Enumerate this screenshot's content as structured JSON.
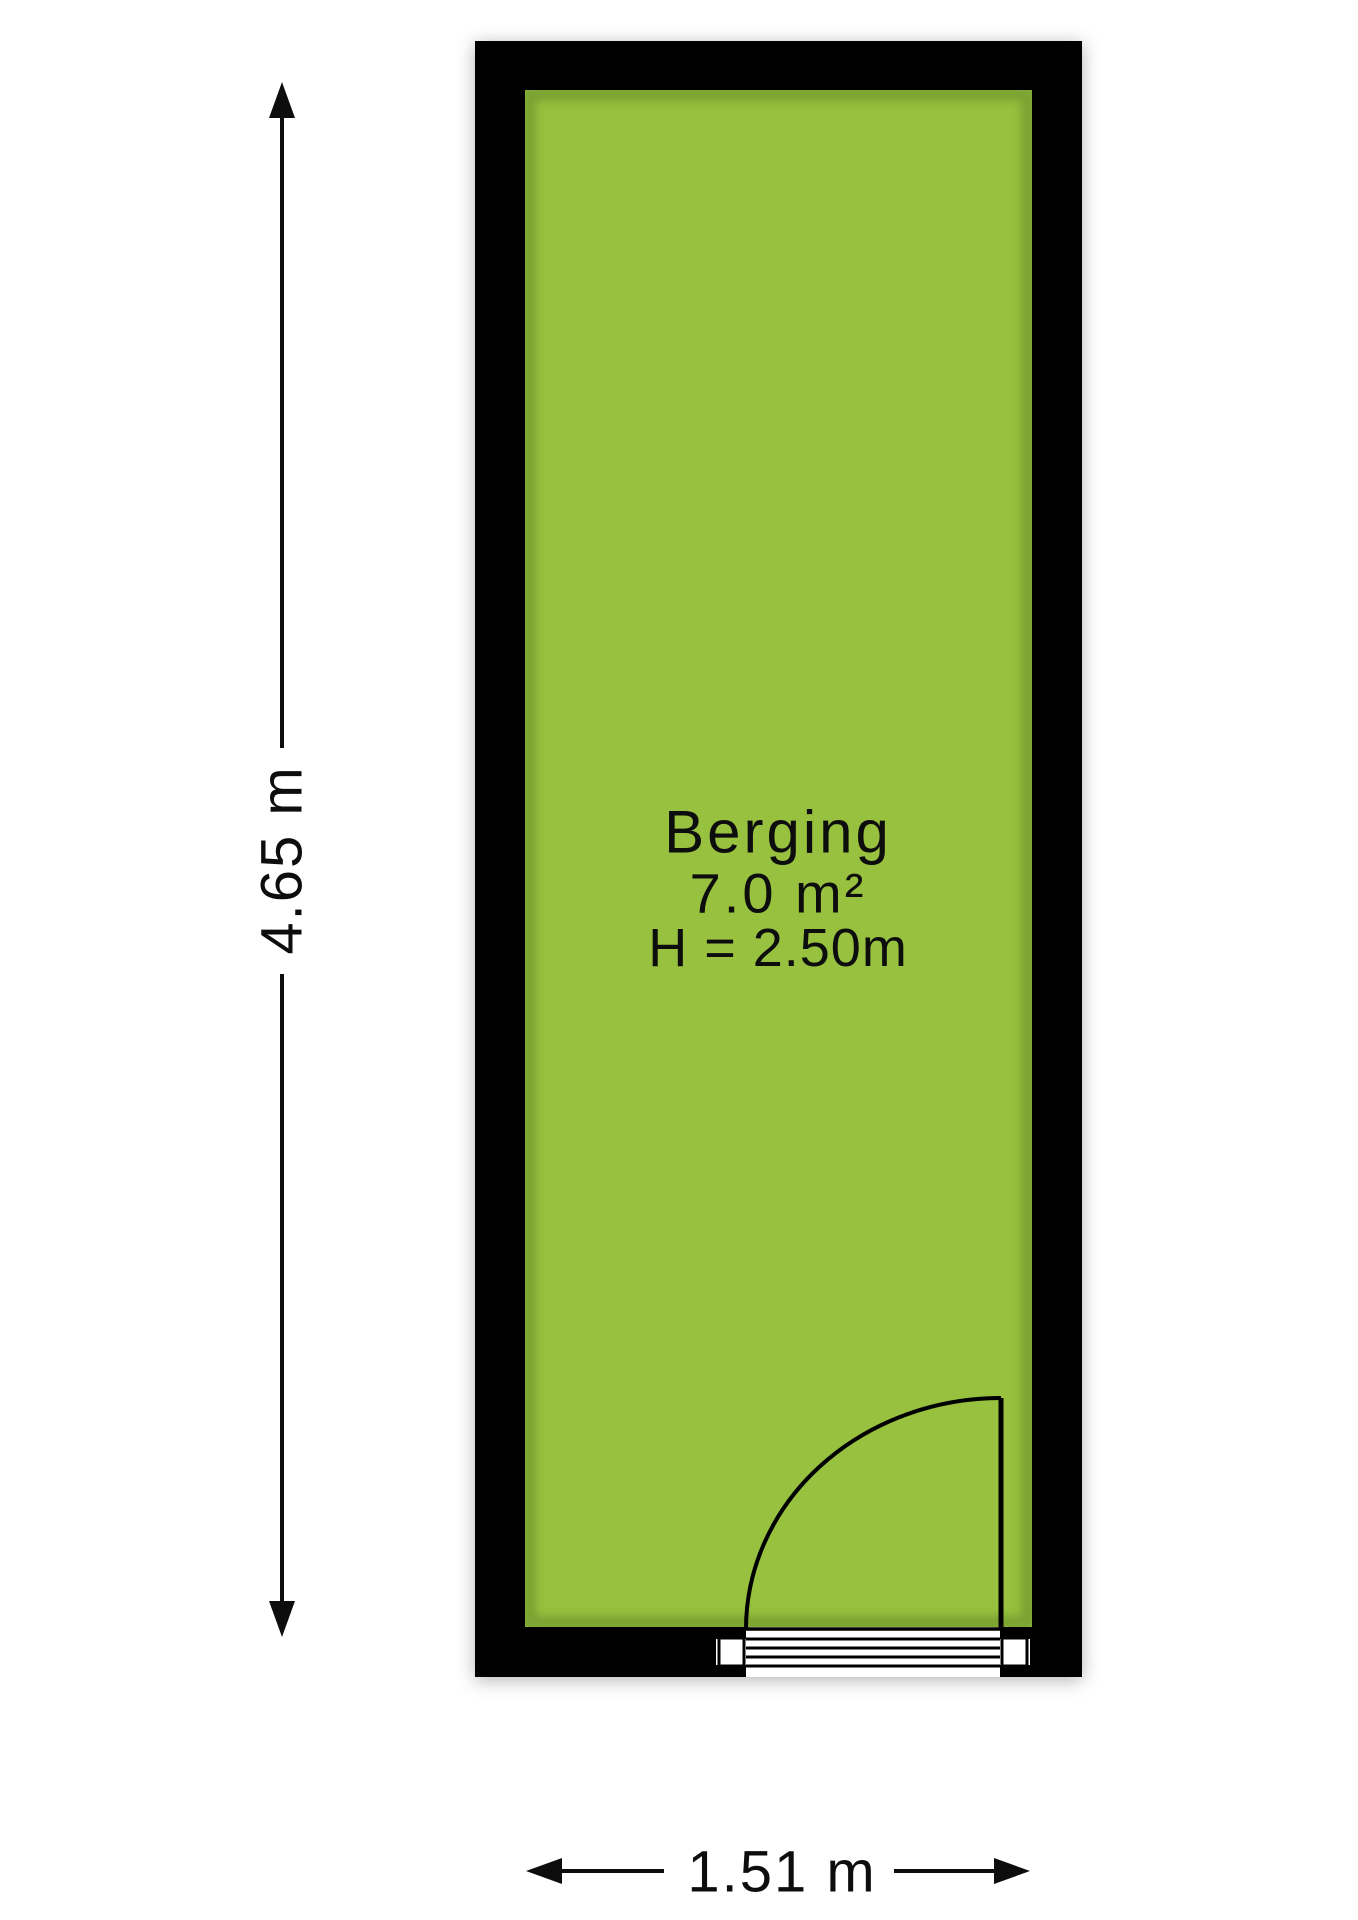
{
  "floorplan": {
    "room": {
      "name": "Berging",
      "area": "7.0 m²",
      "ceiling_height": "H = 2.50m",
      "floor_color": "#97c13e",
      "wall_color": "#000000"
    },
    "dimensions": {
      "vertical_label": "4.65 m",
      "horizontal_label": "1.51 m"
    }
  }
}
